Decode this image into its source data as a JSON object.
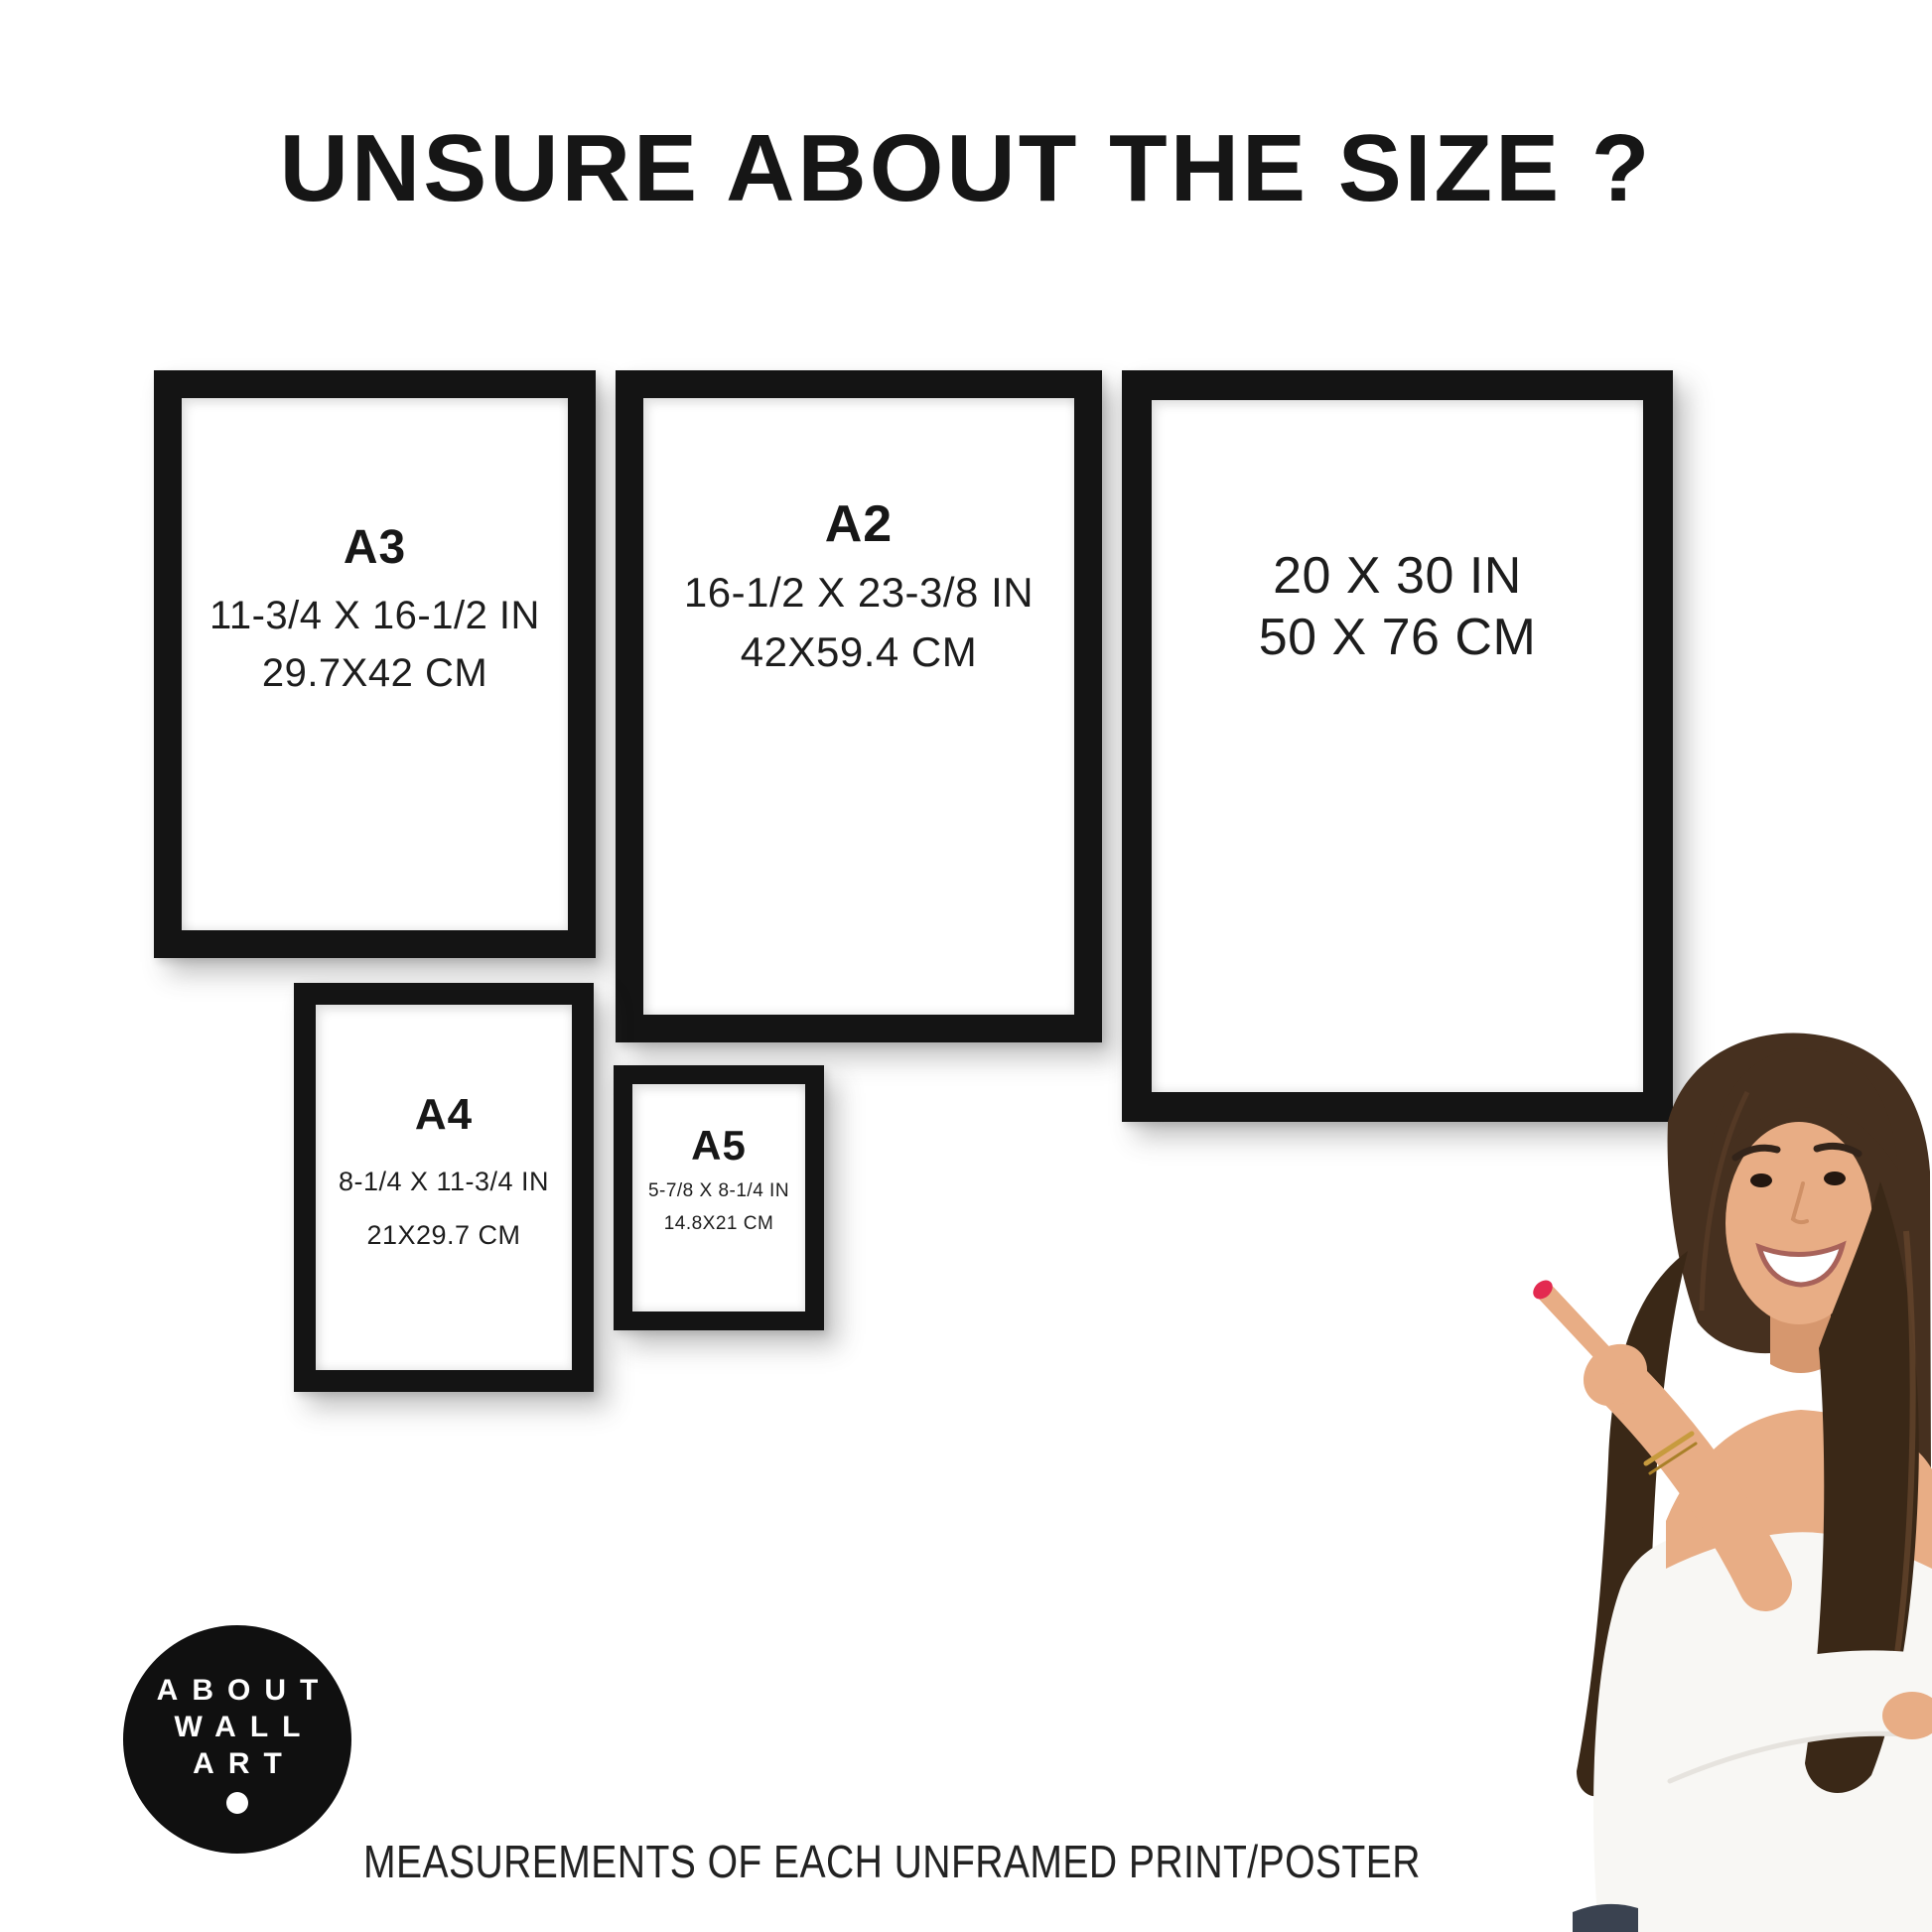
{
  "title": "UNSURE ABOUT THE SIZE ?",
  "caption": "MEASUREMENTS OF EACH UNFRAMED PRINT/POSTER",
  "logo": {
    "lines": [
      "ABOUT",
      "WALL",
      "ART"
    ]
  },
  "frames": [
    {
      "name": "A3",
      "label": "A3",
      "inches": "11-3/4 X 16-1/2 IN",
      "cm": "29.7X42 CM"
    },
    {
      "name": "A2",
      "label": "A2",
      "inches": "16-1/2 X 23-3/8 IN",
      "cm": "42X59.4 CM"
    },
    {
      "name": "20x30",
      "label": "",
      "inches": "20 X 30 IN",
      "cm": "50 X 76 CM"
    },
    {
      "name": "A4",
      "label": "A4",
      "inches": "8-1/4 X 11-3/4 IN",
      "cm": "21X29.7 CM"
    },
    {
      "name": "A5",
      "label": "A5",
      "inches": "5-7/8 X 8-1/4 IN",
      "cm": "14.8X21 CM"
    }
  ],
  "colors": {
    "frame_black": "#141414",
    "background": "#ffffff",
    "text": "#1f1f1f",
    "logo_bg": "#101010",
    "logo_text": "#ffffff",
    "hair": "#46301f",
    "hair_shadow": "#3a2817",
    "skin": "#e8ad85",
    "skin_shadow": "#d6976e",
    "blouse": "#f8f7f4",
    "blouse_shadow": "#e6e3de",
    "nail": "#e32a50",
    "jeans": "#3a4250",
    "bracelet": "#c79b3e"
  }
}
